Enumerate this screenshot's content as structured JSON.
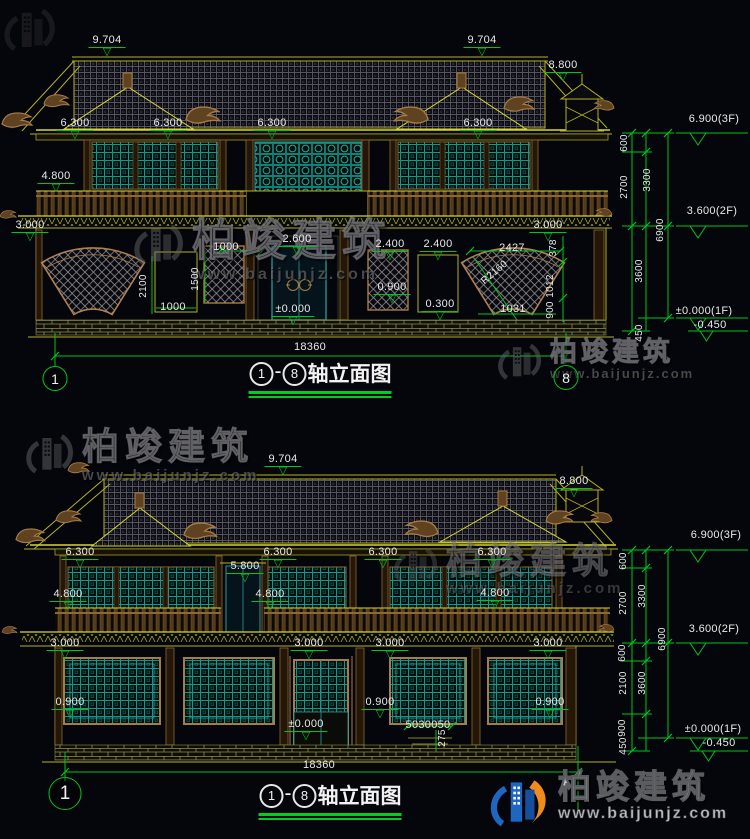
{
  "page": {
    "bg": "#05060b",
    "dim_green": "#00c41e",
    "line_yellow": "#b2b21e",
    "wood_brown": "#a87c46",
    "window_teal": "#1f9e99",
    "text_white": "#e8e8e8"
  },
  "watermark": {
    "brand": "柏竣建筑",
    "url": "www.baijunjz.com"
  },
  "drawing1": {
    "title": {
      "from": "1",
      "to": "8",
      "label": "轴立面图"
    },
    "axis_left": "1",
    "axis_right": "8",
    "annotations": [
      {
        "t": "9.704",
        "x": 107,
        "y": 34,
        "k": "e"
      },
      {
        "t": "9.704",
        "x": 482,
        "y": 34,
        "k": "e"
      },
      {
        "t": "8.800",
        "x": 563,
        "y": 59,
        "k": "e"
      },
      {
        "t": "6.300",
        "x": 75,
        "y": 117,
        "k": "e"
      },
      {
        "t": "6.300",
        "x": 168,
        "y": 117,
        "k": "e"
      },
      {
        "t": "6.300",
        "x": 272,
        "y": 117,
        "k": "e"
      },
      {
        "t": "6.300",
        "x": 478,
        "y": 117,
        "k": "e"
      },
      {
        "t": "4.800",
        "x": 56,
        "y": 170,
        "k": "e"
      },
      {
        "t": "3.000",
        "x": 30,
        "y": 219,
        "k": "e"
      },
      {
        "t": "3.000",
        "x": 548,
        "y": 219,
        "k": "e"
      },
      {
        "t": "2.600",
        "x": 297,
        "y": 233,
        "k": "e"
      },
      {
        "t": "1000",
        "x": 226,
        "y": 241,
        "k": "d"
      },
      {
        "t": "2.400",
        "x": 390,
        "y": 238,
        "k": "e"
      },
      {
        "t": "2.400",
        "x": 438,
        "y": 238,
        "k": "e"
      },
      {
        "t": "2427",
        "x": 512,
        "y": 242,
        "k": "d"
      },
      {
        "t": "378",
        "x": 554,
        "y": 248,
        "k": "r"
      },
      {
        "t": "R2160",
        "x": 495,
        "y": 273,
        "k": "rr",
        "a": -40
      },
      {
        "t": "2100",
        "x": 144,
        "y": 286,
        "k": "r"
      },
      {
        "t": "1500",
        "x": 196,
        "y": 279,
        "k": "r"
      },
      {
        "t": "0.900",
        "x": 392,
        "y": 281,
        "k": "e"
      },
      {
        "t": "1012",
        "x": 551,
        "y": 286,
        "k": "r"
      },
      {
        "t": "1000",
        "x": 173,
        "y": 301,
        "k": "d"
      },
      {
        "t": "±0.000",
        "x": 293,
        "y": 303,
        "k": "e"
      },
      {
        "t": "0.300",
        "x": 440,
        "y": 298,
        "k": "e"
      },
      {
        "t": "1031",
        "x": 513,
        "y": 303,
        "k": "d"
      },
      {
        "t": "900",
        "x": 551,
        "y": 310,
        "k": "r"
      },
      {
        "t": "18360",
        "x": 310,
        "y": 341,
        "k": "d"
      },
      {
        "t": "600",
        "x": 625,
        "y": 143,
        "k": "r"
      },
      {
        "t": "2700",
        "x": 625,
        "y": 187,
        "k": "r"
      },
      {
        "t": "3300",
        "x": 648,
        "y": 180,
        "k": "r"
      },
      {
        "t": "6900",
        "x": 661,
        "y": 230,
        "k": "r"
      },
      {
        "t": "3600",
        "x": 640,
        "y": 271,
        "k": "r"
      },
      {
        "t": "450",
        "x": 640,
        "y": 333,
        "k": "r"
      },
      {
        "t": "6.900(3F)",
        "x": 714,
        "y": 113,
        "k": "d"
      },
      {
        "t": "3.600(2F)",
        "x": 712,
        "y": 205,
        "k": "d"
      },
      {
        "t": "±0.000(1F)",
        "x": 704,
        "y": 305,
        "k": "d"
      },
      {
        "t": "-0.450",
        "x": 710,
        "y": 319,
        "k": "d"
      }
    ]
  },
  "drawing2": {
    "title": {
      "from": "1",
      "to": "8",
      "label": "轴立面图"
    },
    "axis_left": "1",
    "annotations": [
      {
        "t": "9.704",
        "x": 283,
        "y": 453,
        "k": "e"
      },
      {
        "t": "8.800",
        "x": 574,
        "y": 475,
        "k": "e"
      },
      {
        "t": "6.300",
        "x": 80,
        "y": 546,
        "k": "e"
      },
      {
        "t": "6.300",
        "x": 278,
        "y": 546,
        "k": "e"
      },
      {
        "t": "6.300",
        "x": 383,
        "y": 546,
        "k": "e"
      },
      {
        "t": "6.300",
        "x": 492,
        "y": 546,
        "k": "e"
      },
      {
        "t": "5.800",
        "x": 245,
        "y": 560,
        "k": "e"
      },
      {
        "t": "4.800",
        "x": 68,
        "y": 588,
        "k": "e"
      },
      {
        "t": "4.800",
        "x": 270,
        "y": 588,
        "k": "e"
      },
      {
        "t": "4.800",
        "x": 495,
        "y": 587,
        "k": "e"
      },
      {
        "t": "3.000",
        "x": 65,
        "y": 637,
        "k": "e"
      },
      {
        "t": "3.000",
        "x": 309,
        "y": 637,
        "k": "e"
      },
      {
        "t": "3.000",
        "x": 390,
        "y": 637,
        "k": "e"
      },
      {
        "t": "3.000",
        "x": 548,
        "y": 637,
        "k": "e"
      },
      {
        "t": "0.900",
        "x": 70,
        "y": 696,
        "k": "e"
      },
      {
        "t": "0.900",
        "x": 380,
        "y": 696,
        "k": "e"
      },
      {
        "t": "0.900",
        "x": 550,
        "y": 696,
        "k": "e"
      },
      {
        "t": "±0.000",
        "x": 306,
        "y": 718,
        "k": "e"
      },
      {
        "t": "5030050",
        "x": 428,
        "y": 719,
        "k": "d"
      },
      {
        "t": "275",
        "x": 443,
        "y": 738,
        "k": "r"
      },
      {
        "t": "18360",
        "x": 319,
        "y": 759,
        "k": "d"
      },
      {
        "t": "600",
        "x": 624,
        "y": 561,
        "k": "r"
      },
      {
        "t": "2700",
        "x": 624,
        "y": 603,
        "k": "r"
      },
      {
        "t": "3300",
        "x": 643,
        "y": 596,
        "k": "r"
      },
      {
        "t": "6900",
        "x": 663,
        "y": 639,
        "k": "r"
      },
      {
        "t": "600",
        "x": 623,
        "y": 653,
        "k": "r"
      },
      {
        "t": "2100",
        "x": 624,
        "y": 683,
        "k": "r"
      },
      {
        "t": "3600",
        "x": 643,
        "y": 683,
        "k": "r"
      },
      {
        "t": "900",
        "x": 623,
        "y": 728,
        "k": "r"
      },
      {
        "t": "450",
        "x": 624,
        "y": 746,
        "k": "r"
      },
      {
        "t": "6.900(3F)",
        "x": 716,
        "y": 529,
        "k": "d"
      },
      {
        "t": "3.600(2F)",
        "x": 714,
        "y": 623,
        "k": "d"
      },
      {
        "t": "±0.000(1F)",
        "x": 713,
        "y": 723,
        "k": "d"
      },
      {
        "t": "-0.450",
        "x": 719,
        "y": 737,
        "k": "d"
      }
    ]
  }
}
